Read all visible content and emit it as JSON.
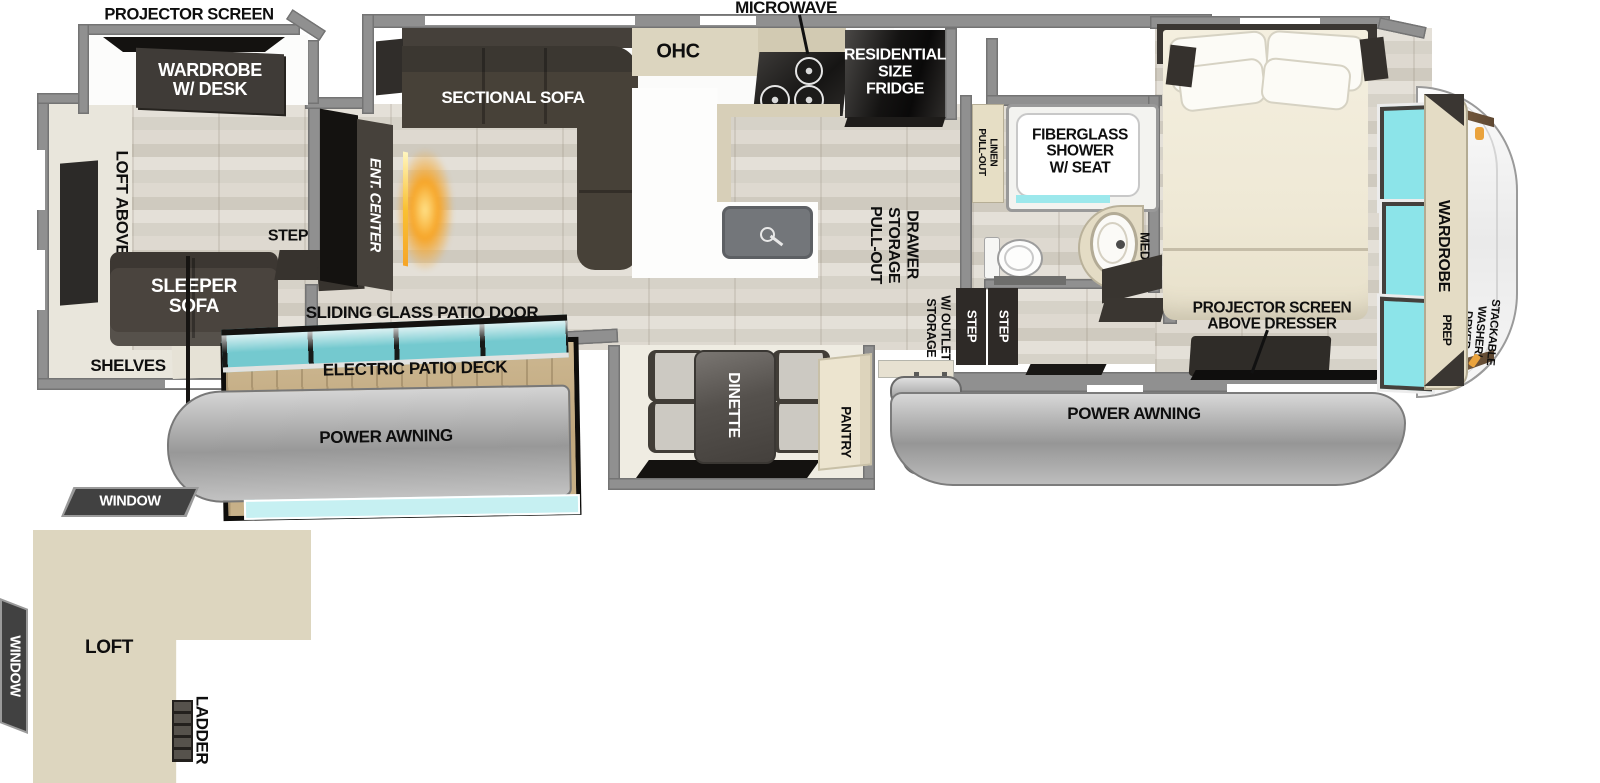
{
  "colors": {
    "wall": "#909090",
    "floor_wood": "#d9d5cc",
    "interior_beige": "#e9e6dc",
    "dark_furniture": "#46413b",
    "black": "#141210",
    "window_teal": "#8ce4e9",
    "cabinet_beige": "#e6dec5",
    "deck_wood": "#c6b089",
    "awning_gray": "#a9a9a9",
    "loft_fill": "#ddd6bf",
    "fireplace_glow": "#f6a528",
    "accent_orange": "#eaa33d"
  },
  "labels": {
    "projector_screen_rear": "PROJECTOR SCREEN",
    "wardrobe_desk": "WARDROBE\nW/ DESK",
    "loft_above": "LOFT ABOVE",
    "sleeper_sofa": "SLEEPER\nSOFA",
    "shelves": "SHELVES",
    "step_rear": "STEP",
    "ent_center": "ENT. CENTER",
    "sectional_sofa": "SECTIONAL SOFA",
    "ohc": "OHC",
    "microwave": "MICROWAVE",
    "fridge": "RESIDENTIAL\nSIZE\nFRIDGE",
    "pullout_storage_drawer": "PULL-OUT\nSTORAGE\nDRAWER",
    "sliding_door": "SLIDING GLASS PATIO DOOR",
    "electric_patio_deck": "ELECTRIC PATIO DECK",
    "power_awning_left": "POWER AWNING",
    "dinette": "DINETTE",
    "pantry": "PANTRY",
    "storage_outlet": "STORAGE\nW/ OUTLET",
    "step_a": "STEP",
    "step_b": "STEP",
    "pullout_linen": "PULL-OUT\nLINEN",
    "shower": "FIBERGLASS\nSHOWER\nW/ SEAT",
    "med": "MED",
    "dresser": "PROJECTOR SCREEN\nABOVE DRESSER",
    "power_awning_right": "POWER AWNING",
    "wardrobe": "WARDROBE",
    "washer_dryer": "STACKABLE\nWASHER/\nDRYER",
    "prep": "PREP",
    "window_top": "WINDOW",
    "window_left": "WINDOW",
    "loft": "LOFT",
    "ladder": "LADDER"
  }
}
